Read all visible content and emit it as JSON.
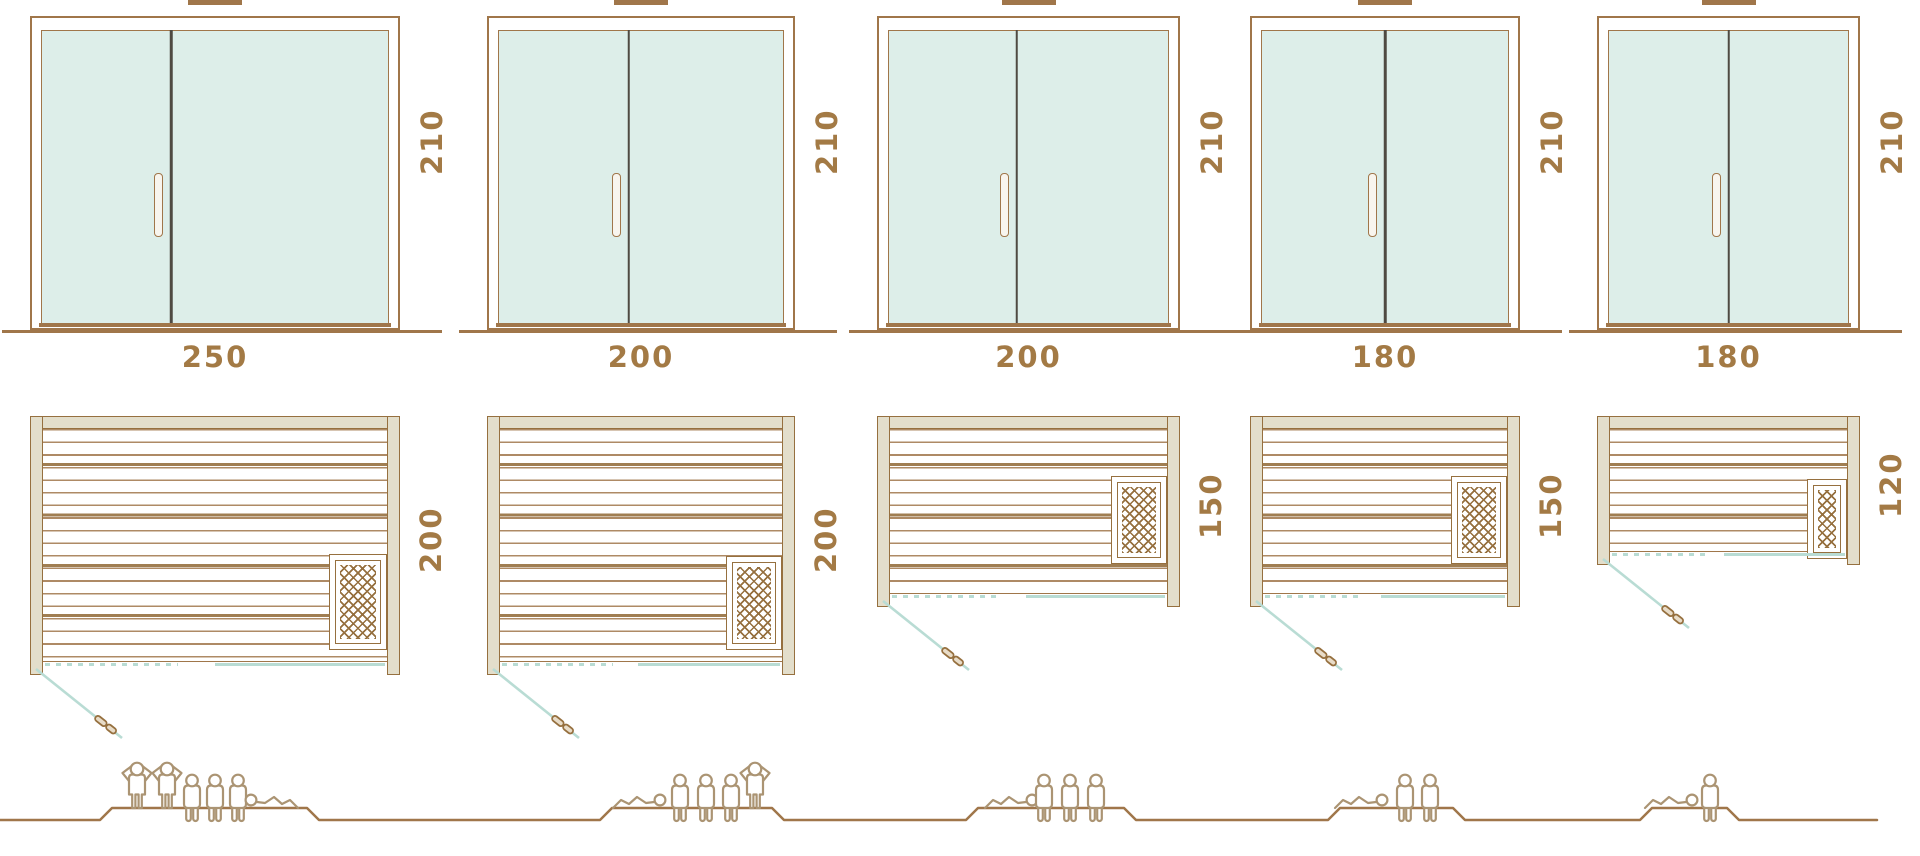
{
  "colors": {
    "outline_brown": "#a0764a",
    "label_text": "#a37a45",
    "glass_fill": "#ddeee9",
    "wood_fill": "#e3decb",
    "door_swing_line": "#b9dcd4",
    "door_divider": "#4f4a42",
    "figure_outline": "#ab9473",
    "heater_lattice": "#96703f"
  },
  "icons": {
    "standing": "person-standing-icon",
    "seated": "person-seated-icon",
    "lying": "person-lying-icon",
    "heater": "heater-grill-icon",
    "door_handle": "door-handle-icon"
  },
  "units": [
    {
      "width_cm": "250",
      "height_cm": "210",
      "depth_cm": "200",
      "capacity": {
        "standing": 2,
        "seated": 3,
        "lying": 1,
        "total": 6
      }
    },
    {
      "width_cm": "200",
      "height_cm": "210",
      "depth_cm": "200",
      "capacity": {
        "standing": 1,
        "seated": 3,
        "lying": 1,
        "total": 5
      }
    },
    {
      "width_cm": "200",
      "height_cm": "210",
      "depth_cm": "150",
      "capacity": {
        "standing": 0,
        "seated": 3,
        "lying": 1,
        "total": 4
      }
    },
    {
      "width_cm": "180",
      "height_cm": "210",
      "depth_cm": "150",
      "capacity": {
        "standing": 0,
        "seated": 2,
        "lying": 1,
        "total": 3
      }
    },
    {
      "width_cm": "180",
      "height_cm": "210",
      "depth_cm": "120",
      "capacity": {
        "standing": 0,
        "seated": 1,
        "lying": 1,
        "total": 2
      }
    }
  ]
}
